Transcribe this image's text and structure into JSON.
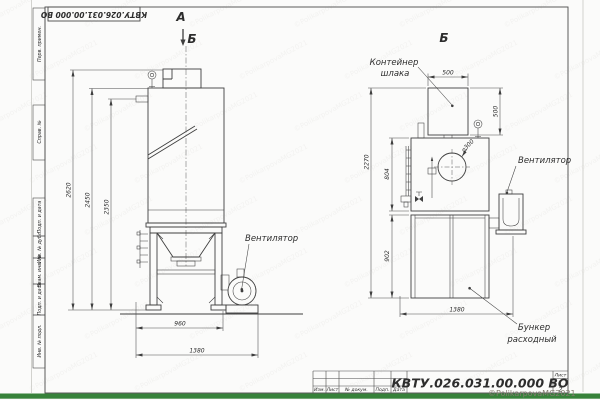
{
  "page": {
    "stamp_top": "КВТУ.026.031.00.000  ВО",
    "watermark": "©PolikarpovaMG2021"
  },
  "colors": {
    "green_strip": "#37823a",
    "line": "#3f3f3f"
  },
  "margin_column": [
    "Перв. примен.",
    "Справ. №",
    "Подп. и дата",
    "Инв. № дубл.",
    "Взам. инв. №",
    "Подп. и дата",
    "Инв. № подл."
  ],
  "view_a": {
    "label": "А",
    "section_arrow_label": "Б",
    "fan_label": "Вентилятор",
    "dim_2620": "2620",
    "dim_2450": "2450",
    "dim_2350": "2350",
    "dim_960": "960",
    "dim_1380": "1380"
  },
  "view_b": {
    "label": "Б",
    "container_label": [
      "Контейнер",
      "шлака"
    ],
    "fan_label": "Вентилятор",
    "hopper_label": [
      "Бункер",
      "расходный"
    ],
    "dim_500_top": "500",
    "dim_500_right": "500",
    "dim_dia": "⌀300",
    "dim_2270": "2270",
    "dim_804": "804",
    "dim_902": "902",
    "dim_1380": "1380"
  },
  "title_block": {
    "designation": "КВТУ.026.031.00.000  ВО",
    "rev_columns": [
      "Изм.",
      "Лист",
      "№ докум.",
      "Подп.",
      "Дата"
    ],
    "sheet_label": "Лист",
    "sheet_number": "2"
  }
}
